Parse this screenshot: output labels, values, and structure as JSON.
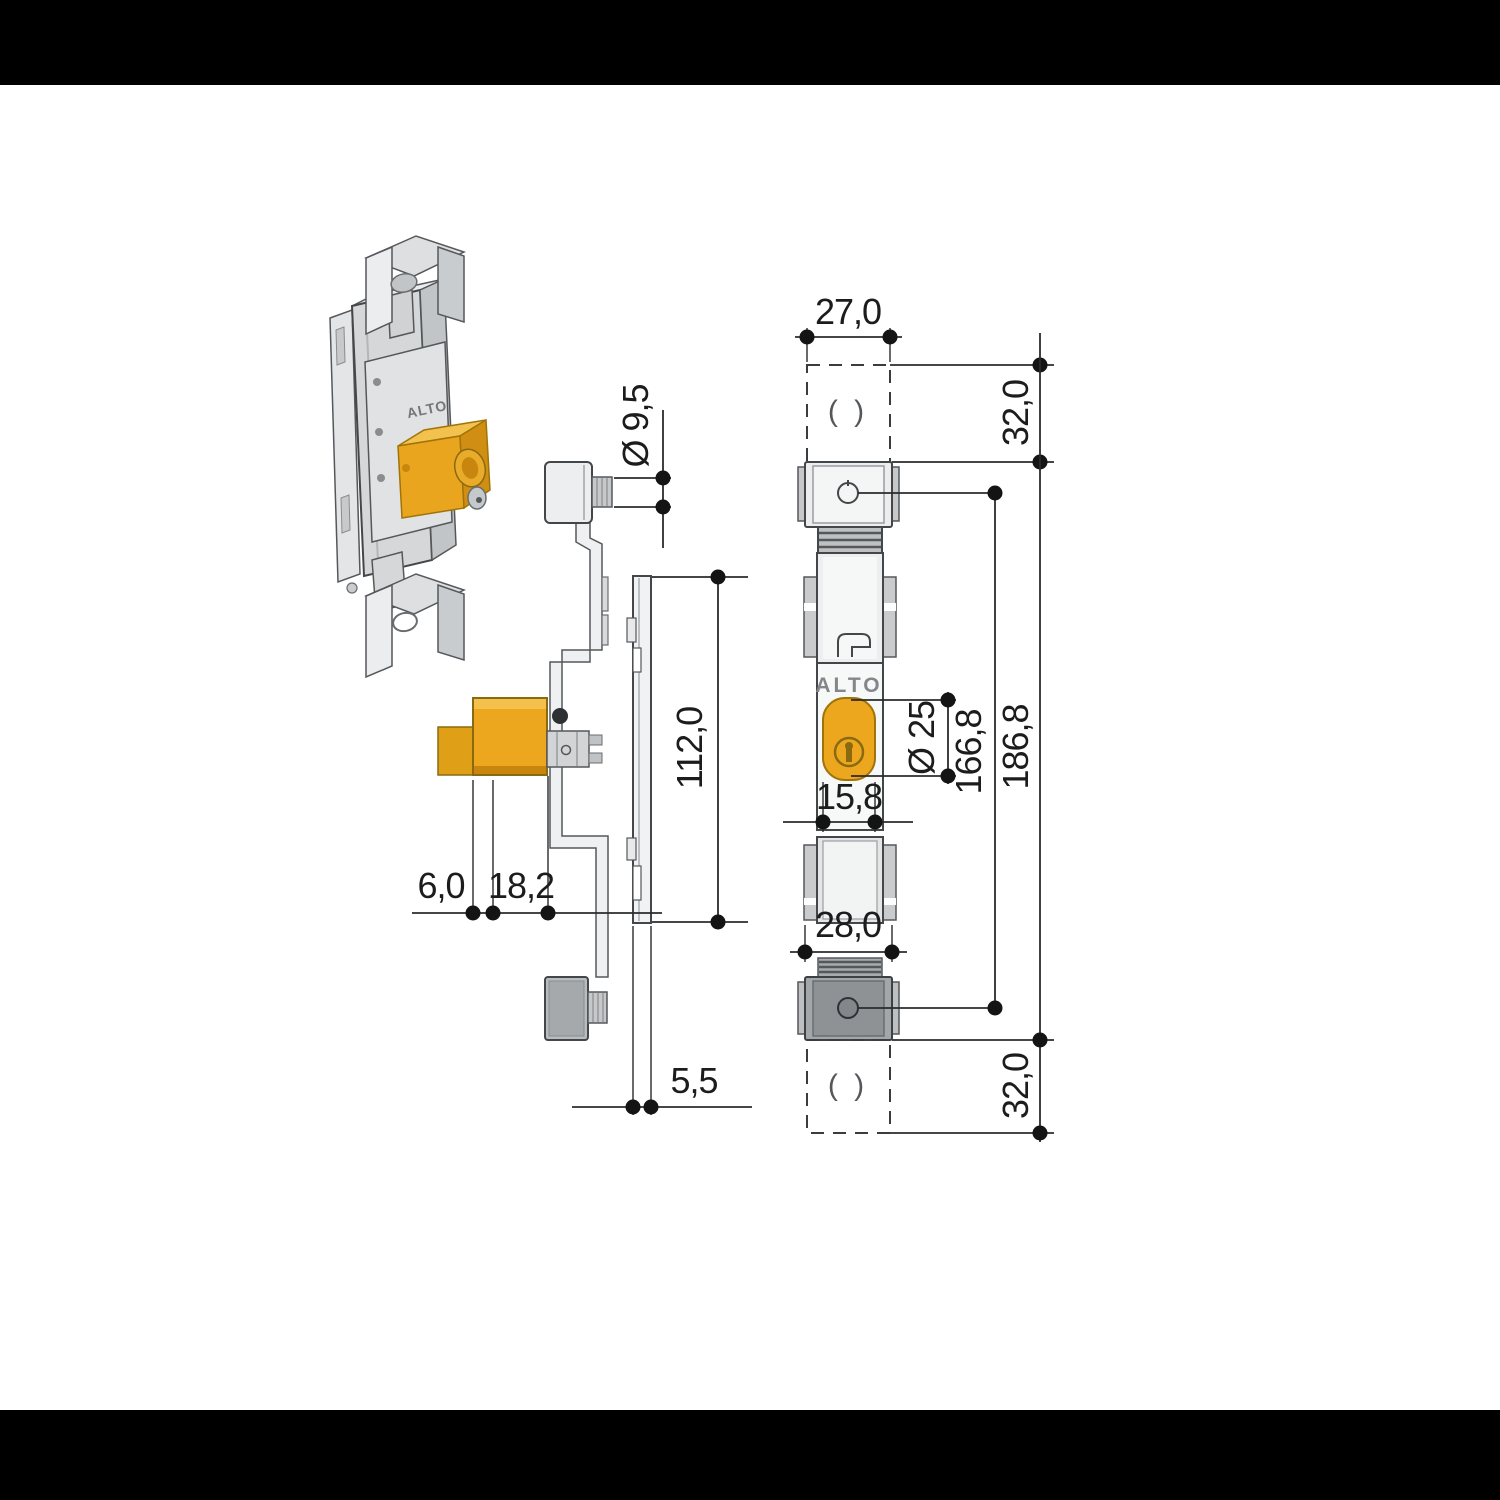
{
  "letterbox_color": "#000000",
  "drawing": {
    "brand_label": "ALTO",
    "iso_brand_label": "ALTO",
    "placeholders": {
      "top": "( )",
      "bottom": "( )"
    },
    "dimensions": {
      "bracket_width": "27,0",
      "top_overhang": "32,0",
      "bottom_overhang": "32,0",
      "total_height": "186,8",
      "screw_spacing": "166,8",
      "cylinder_diameter": "Ø 25",
      "cylinder_width": "15,8",
      "body_width": "28,0",
      "pin_diameter": "Ø 9,5",
      "strike_plate_height": "112,0",
      "offset_small": "6,0",
      "offset_large": "18,2",
      "strike_plate_thickness": "5,5"
    },
    "colors": {
      "accent_orange": "#ECA71F",
      "line": "#2B2B2B",
      "body_gray": "#EDEEEF",
      "bracket_dark_gray": "#A4A7AA"
    }
  }
}
